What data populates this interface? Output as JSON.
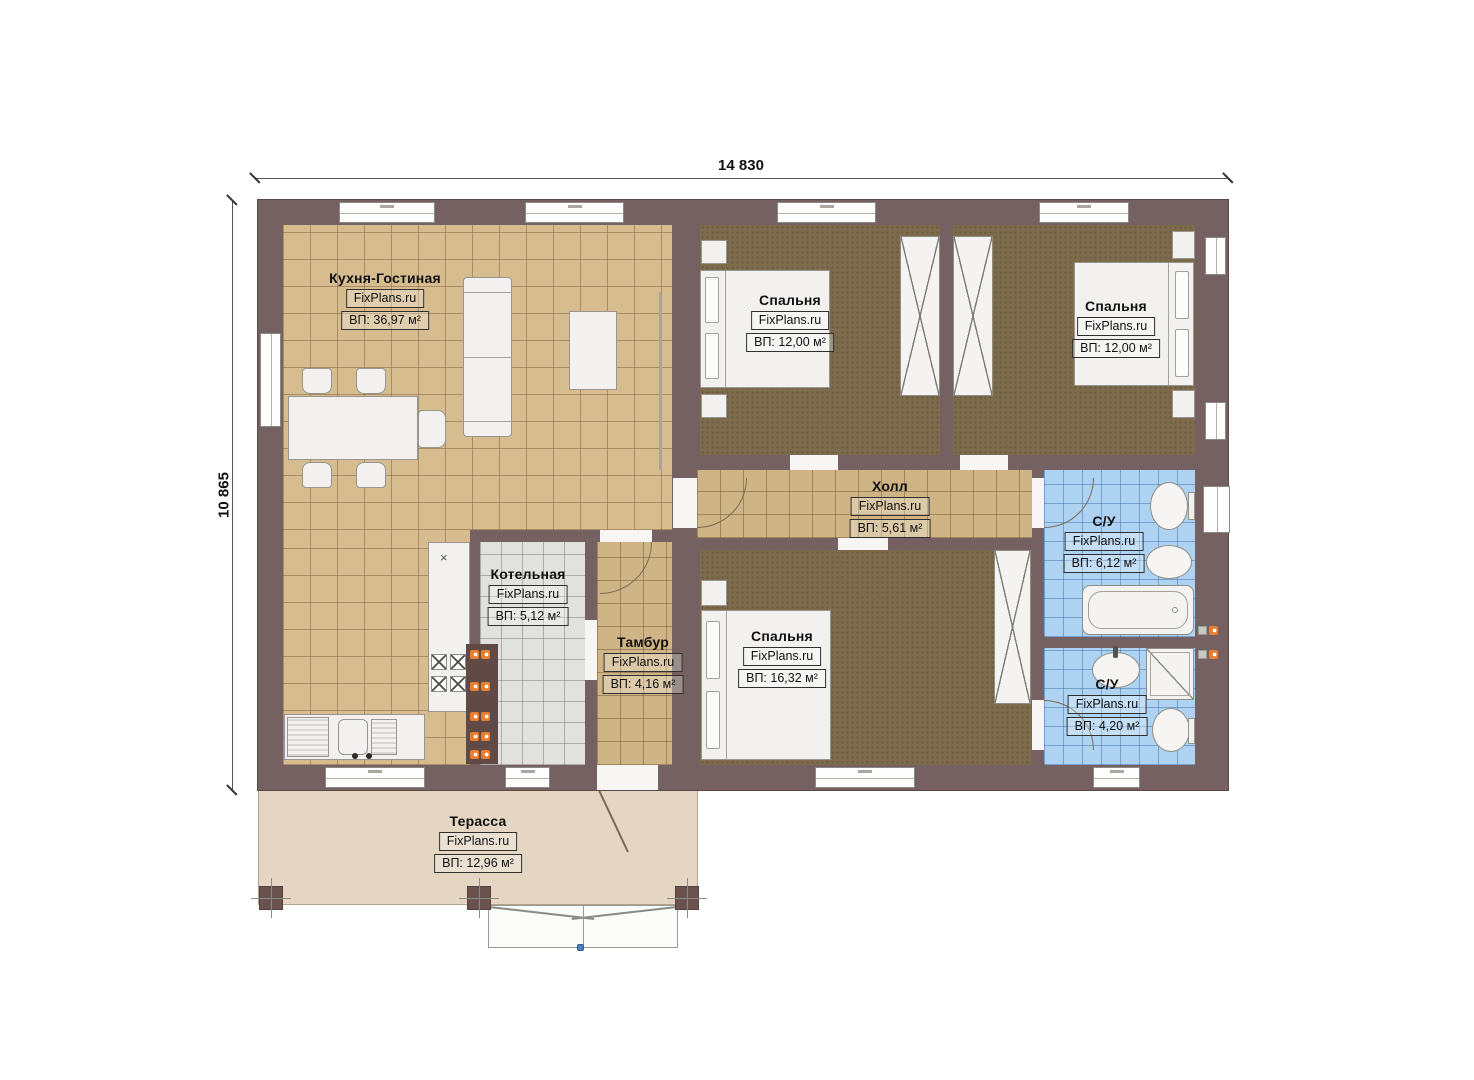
{
  "watermark": "FixPlans.ru",
  "dimensions": {
    "top": "14 830",
    "left": "10 865"
  },
  "rooms": [
    {
      "id": "kitchen-living",
      "name": "Кухня-Гостиная",
      "area": "ВП: 36,97 м²"
    },
    {
      "id": "bedroom-1",
      "name": "Спальня",
      "area": "ВП: 12,00 м²"
    },
    {
      "id": "bedroom-2",
      "name": "Спальня",
      "area": "ВП: 12,00 м²"
    },
    {
      "id": "hall",
      "name": "Холл",
      "area": "ВП: 5,61 м²"
    },
    {
      "id": "boiler-room",
      "name": "Котельная",
      "area": "ВП: 5,12 м²"
    },
    {
      "id": "vestibule",
      "name": "Тамбур",
      "area": "ВП: 4,16 м²"
    },
    {
      "id": "bedroom-3",
      "name": "Спальня",
      "area": "ВП: 16,32 м²"
    },
    {
      "id": "bathroom-1",
      "name": "С/У",
      "area": "ВП: 6,12 м²"
    },
    {
      "id": "bathroom-2",
      "name": "С/У",
      "area": "ВП: 4,20 м²"
    },
    {
      "id": "terrace",
      "name": "Терасса",
      "area": "ВП: 12,96 м²"
    }
  ],
  "colors": {
    "wall": "#766162",
    "kitchen_floor": "#d6bc8f",
    "bedroom_floor": "#7d6b4c",
    "bath_tile": "#aed2f1",
    "boiler_tile": "#e1e1de",
    "terrace_floor": "#e4d6c2",
    "radiator_accent": "#ed7d2b"
  }
}
